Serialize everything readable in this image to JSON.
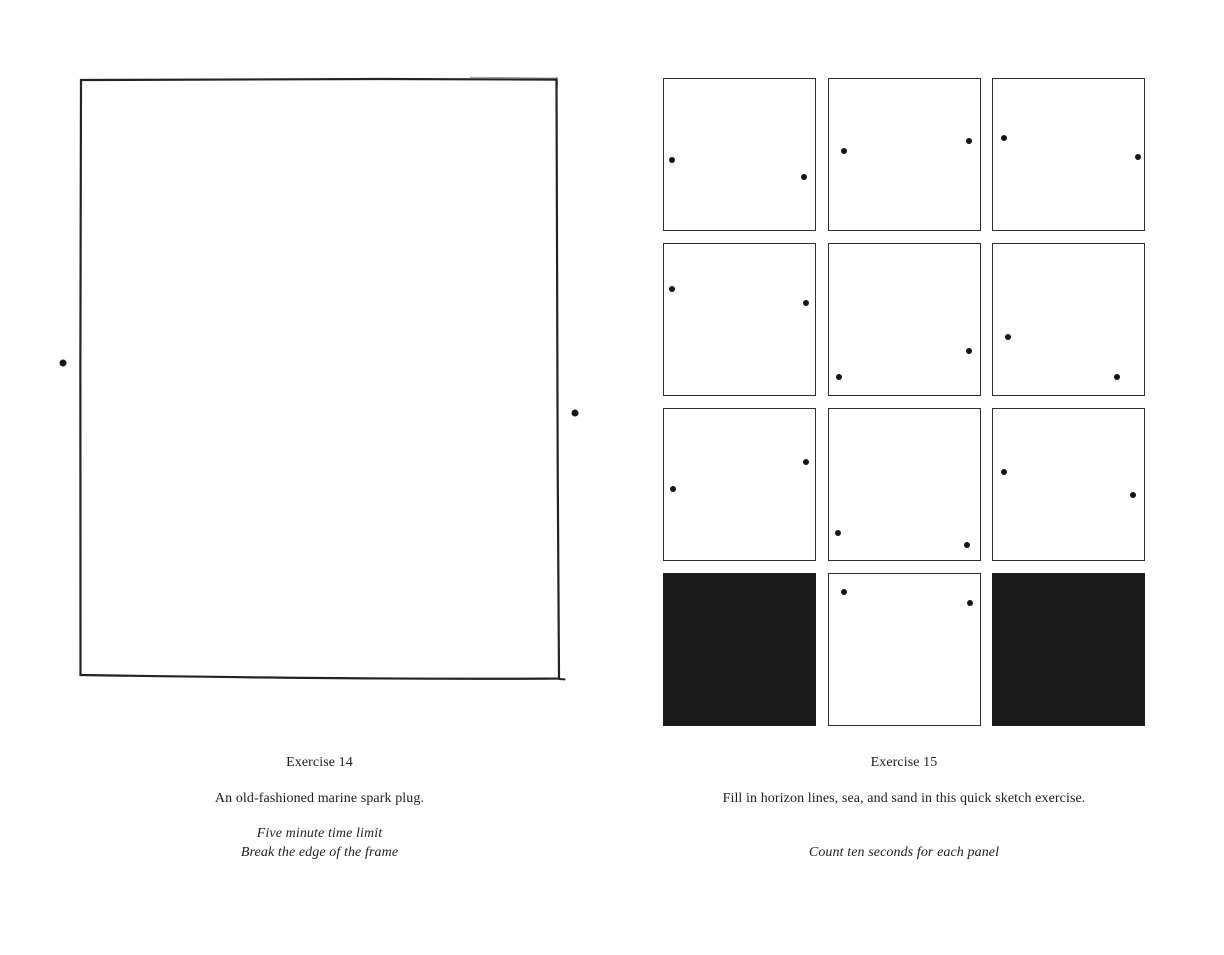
{
  "page": {
    "background_color": "#ffffff",
    "ink_color": "#1d1d1d",
    "panel_fill_color": "#1a1a1a",
    "dot_color": "#141414"
  },
  "exercise14": {
    "title": "Exercise 14",
    "description": "An old-fashioned marine spark plug.",
    "notes": [
      "Five minute time limit",
      "Break the edge of the frame"
    ],
    "dots": [
      {
        "x": 63,
        "y": 363
      },
      {
        "x": 575,
        "y": 413
      }
    ]
  },
  "exercise15": {
    "title": "Exercise 15",
    "description": "Fill in horizon lines, sea, and sand in this quick sketch exercise.",
    "notes": [
      "Count ten seconds for each panel"
    ],
    "grid": {
      "columns": 3,
      "rows": 4
    },
    "panels": [
      {
        "type": "empty",
        "dots": [
          {
            "x": 5,
            "y": 54
          },
          {
            "x": 93,
            "y": 65
          }
        ]
      },
      {
        "type": "empty",
        "dots": [
          {
            "x": 10,
            "y": 48
          },
          {
            "x": 93,
            "y": 41
          }
        ]
      },
      {
        "type": "empty",
        "dots": [
          {
            "x": 7,
            "y": 39
          },
          {
            "x": 96,
            "y": 52
          }
        ]
      },
      {
        "type": "empty",
        "dots": [
          {
            "x": 5,
            "y": 30
          },
          {
            "x": 94,
            "y": 39
          }
        ]
      },
      {
        "type": "empty",
        "dots": [
          {
            "x": 7,
            "y": 88
          },
          {
            "x": 93,
            "y": 71
          }
        ]
      },
      {
        "type": "empty",
        "dots": [
          {
            "x": 10,
            "y": 62
          },
          {
            "x": 82,
            "y": 88
          }
        ]
      },
      {
        "type": "empty",
        "dots": [
          {
            "x": 6,
            "y": 53
          },
          {
            "x": 94,
            "y": 35
          }
        ]
      },
      {
        "type": "empty",
        "dots": [
          {
            "x": 6,
            "y": 82
          },
          {
            "x": 92,
            "y": 90
          }
        ]
      },
      {
        "type": "empty",
        "dots": [
          {
            "x": 7,
            "y": 42
          },
          {
            "x": 93,
            "y": 57
          }
        ]
      },
      {
        "type": "filled",
        "dots": []
      },
      {
        "type": "empty",
        "dots": [
          {
            "x": 10.5,
            "y": 12
          },
          {
            "x": 94,
            "y": 19
          }
        ]
      },
      {
        "type": "filled",
        "dots": []
      }
    ]
  }
}
